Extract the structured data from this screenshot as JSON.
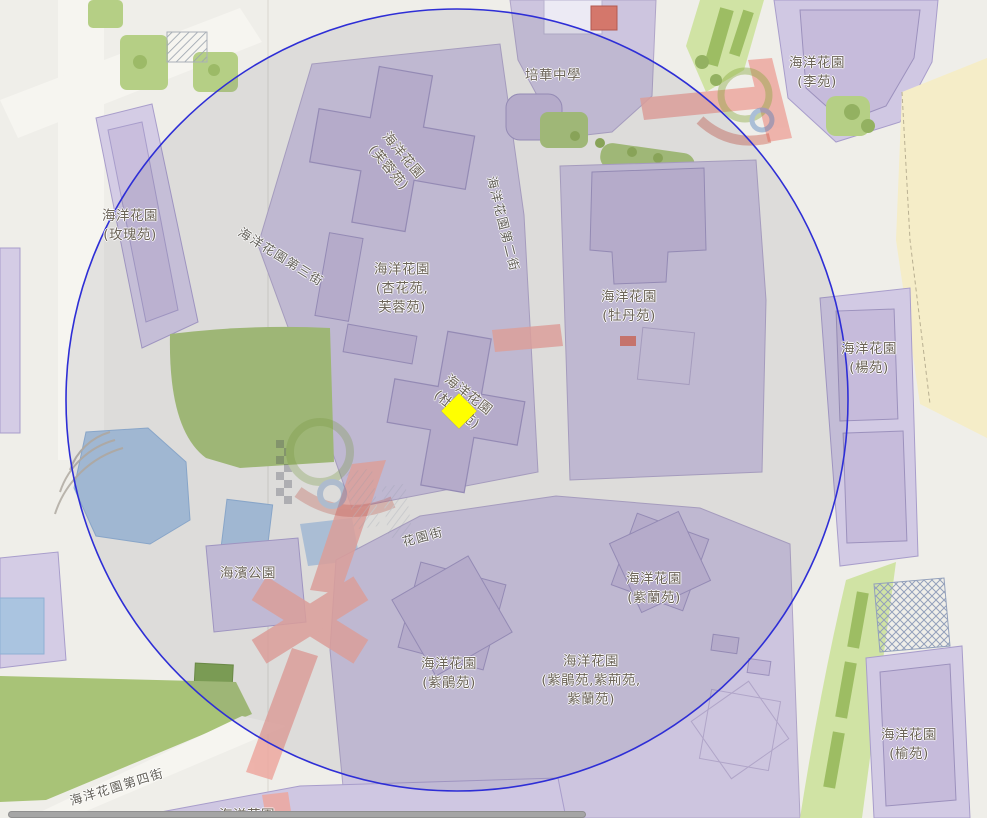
{
  "map": {
    "labels": [
      {
        "id": "ocean-gardens-lee-court",
        "text": "海洋花園\n(李苑)"
      },
      {
        "id": "pui-va-middle-school",
        "text": "培華中學"
      },
      {
        "id": "ocean-gardens-hibiscus-court",
        "text": "海洋花園\n(芙蓉苑)"
      },
      {
        "id": "ocean-gardens-rose-court",
        "text": "海洋花園\n(玫瑰苑)"
      },
      {
        "id": "ocean-gardens-third-street",
        "text": "海洋花園第三街"
      },
      {
        "id": "ocean-gardens-second-street",
        "text": "海洋花園第二街"
      },
      {
        "id": "ocean-gardens-apricot-hibiscus-courts",
        "text": "海洋花園\n(杏花苑,\n芙蓉苑)"
      },
      {
        "id": "ocean-gardens-peony-court",
        "text": "海洋花園\n(牡丹苑)"
      },
      {
        "id": "ocean-gardens-willow-court",
        "text": "海洋花園\n(楊苑)"
      },
      {
        "id": "ocean-gardens-azalea-court",
        "text": "海洋花園\n(杜鵑苑)"
      },
      {
        "id": "garden-street",
        "text": "花園街"
      },
      {
        "id": "waterfront-park",
        "text": "海濱公園"
      },
      {
        "id": "ocean-gardens-violet-orchid-court",
        "text": "海洋花園\n(紫蘭苑)"
      },
      {
        "id": "ocean-gardens-purple-azalea-court",
        "text": "海洋花園\n(紫鵑苑)"
      },
      {
        "id": "ocean-gardens-purple-courts-group",
        "text": "海洋花園\n(紫鵑苑,紫荊苑,\n紫蘭苑)"
      },
      {
        "id": "ocean-gardens-elm-court",
        "text": "海洋花園\n(榆苑)"
      },
      {
        "id": "ocean-gardens-fourth-street",
        "text": "海洋花園第四街"
      },
      {
        "id": "ocean-gardens-clipped",
        "text": "海洋花園"
      }
    ],
    "marker": {
      "shape": "diamond",
      "color": "#FFFF00"
    },
    "overlay_circle": {
      "stroke": "#2E2ED6",
      "fill": "rgba(90,90,115,0.12)"
    },
    "colors": {
      "base": "#EFEEE9",
      "parcel": "#CDC5DF",
      "building": "#C3B8D8",
      "road_pink": "#EDA8A0",
      "park_green": "#A8C377",
      "band_green": "#D0E3A4",
      "water_blue": "#AAC4E0",
      "beach_sand": "#F5EDC8",
      "label_text": "#6B6357"
    }
  }
}
